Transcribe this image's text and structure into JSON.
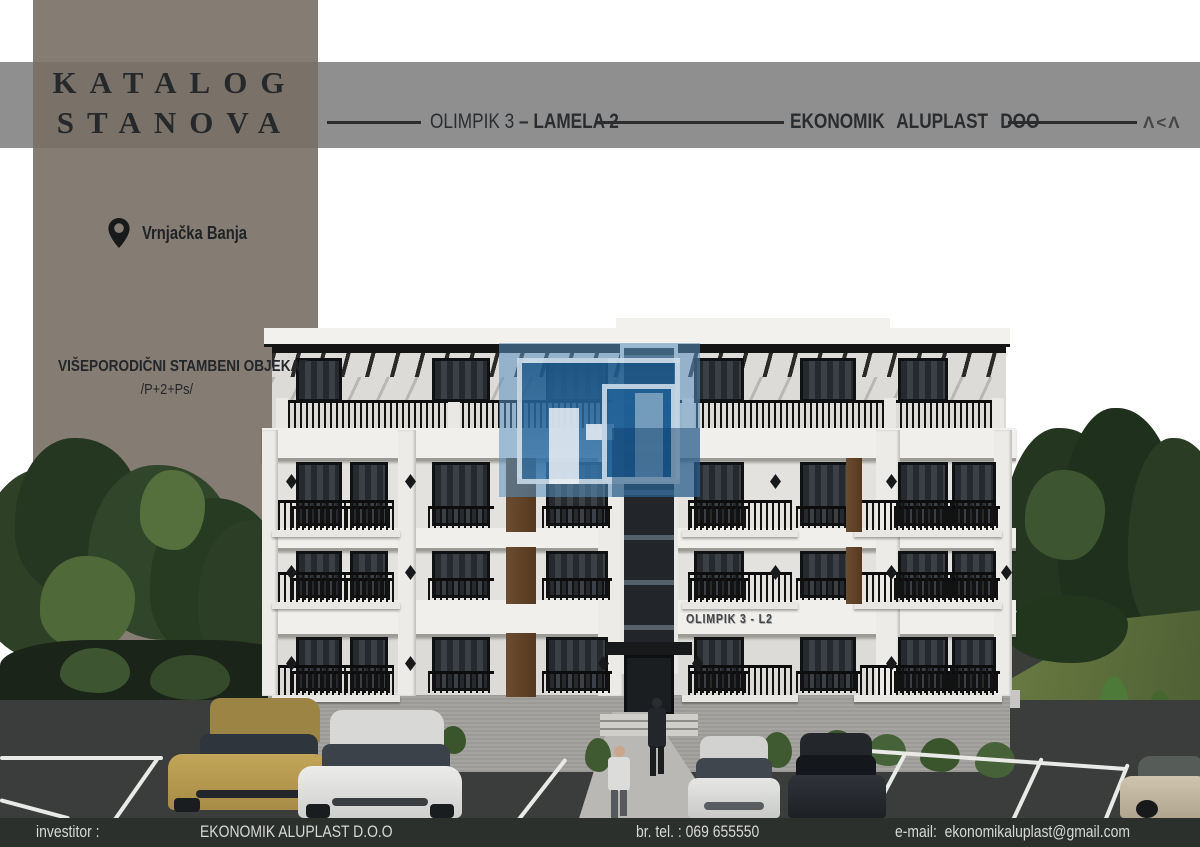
{
  "header": {
    "catalog_title_line1": "KATALOG",
    "catalog_title_line2": "STANOVA",
    "project_prefix": "OLIMPIK 3",
    "project_separator": "–",
    "project_suffix": "LAMELA 2",
    "company_label": "EKONOMIK ALUPLAST DOO",
    "brand_mark": "Λ<Λ"
  },
  "location": {
    "icon": "location-pin-icon",
    "name": "Vrnjačka Banja"
  },
  "object_info": {
    "type_label": "VIŠEPORODIČNI STAMBENI OBJEKAT",
    "floors_label": "/P+2+Ps/"
  },
  "building": {
    "sign": "OLIMPIK 3 - L2"
  },
  "footer": {
    "investor_label": "investitor :",
    "investor_name": "EKONOMIK ALUPLAST D.O.O",
    "phone_label": "br. tel. : 069 655550",
    "email_label": "e-mail:",
    "email_value": "ekonomikaluplast@gmail.com"
  },
  "colors": {
    "band_gray": "#8f8f8f",
    "sidebar_taupe": "#8a8078",
    "footer_dark": "#2c302d",
    "facade_white": "#e3e2de",
    "window_dark": "#24272b",
    "wood_accent": "#6b4c30",
    "asphalt": "#3a3d3b",
    "grass": "#5c6e3d",
    "tree_dark": "#2b3d25",
    "logo_blue": "#3e7db2"
  }
}
